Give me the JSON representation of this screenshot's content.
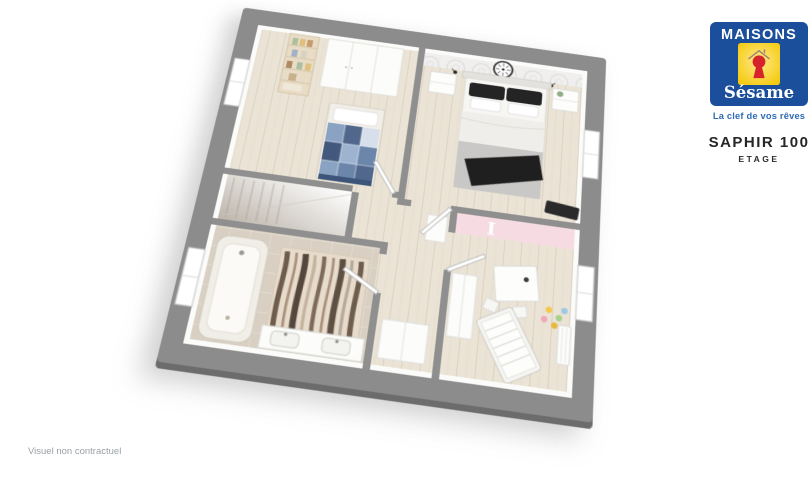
{
  "window": {
    "width": 811,
    "height": 480,
    "background": "#ffffff"
  },
  "logo": {
    "brand_line": "MAISONS",
    "brand_script": "Sésame",
    "tagline": "La clef de vos rêves",
    "colors": {
      "panel_blue": "#1b4e9b",
      "badge_yellow": "#f4c804",
      "keyhole_red": "#d7242c",
      "tagline_blue": "#2e6cb5"
    }
  },
  "title": {
    "model": "SAPHIR 100",
    "floor": "ETAGE"
  },
  "footnote": "Visuel non contractuel",
  "floorplan": {
    "decor_letter": "I",
    "colors": {
      "slab_grey": "#8c8c8c",
      "slab_edge": "#6c6c6c",
      "wall_white": "#fbfbfa",
      "wood_floor": "#ebe4d6",
      "tile_floor": "#d9d0c3",
      "accent_pink": "#f6dbe2",
      "bathroom_taupe": "#b5aa9d",
      "bed_blue": "#6b86aa",
      "bed_dark": "#1f1f1f"
    }
  }
}
